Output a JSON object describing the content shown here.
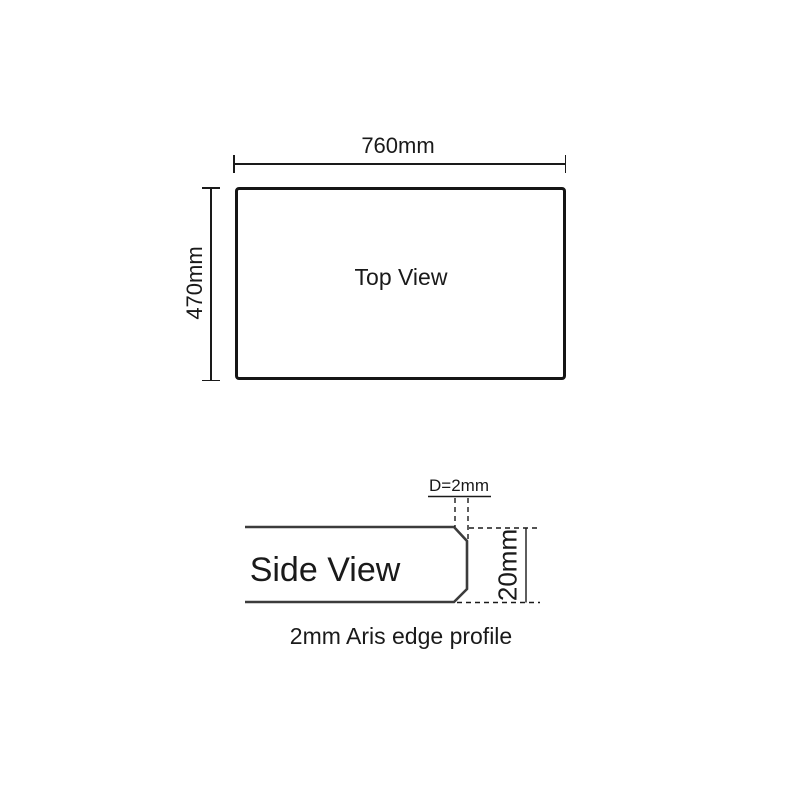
{
  "top_view": {
    "label": "Top View",
    "width_label": "760mm",
    "height_label": "470mm"
  },
  "side_view": {
    "label": "Side View",
    "aris_depth_label": "D=2mm",
    "thickness_label": "20mm",
    "caption": "2mm Aris edge profile"
  },
  "colors": {
    "ink": "#1a1a1a",
    "profile_stroke": "#3c3c3c",
    "background": "#ffffff"
  }
}
